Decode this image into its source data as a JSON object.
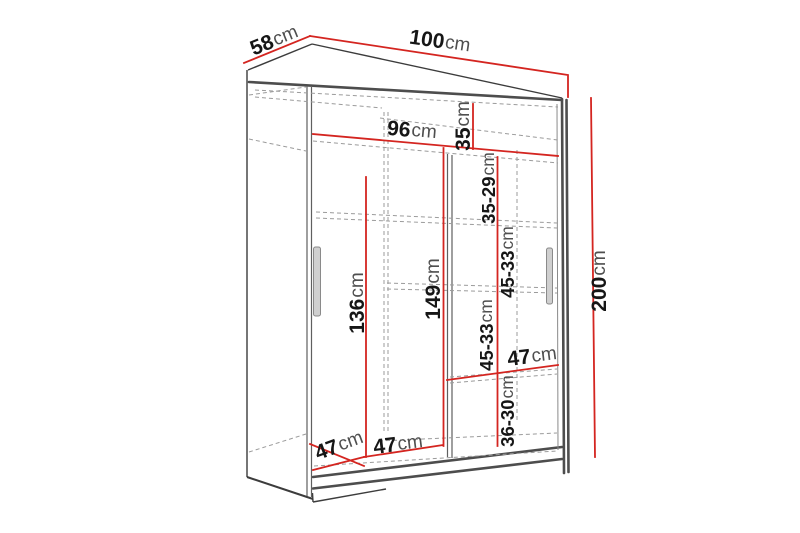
{
  "diagram": {
    "type": "furniture-dimension-diagram",
    "subject": "sliding-door wardrobe, 3D perspective view with measurements",
    "colors": {
      "dimension_line_red": "#d42520",
      "outline_dark": "#4d4d4d",
      "hidden_edge_dashed_gray": "#9b9b9b",
      "background": "#ffffff"
    }
  },
  "labels": {
    "depth": {
      "value": "58",
      "unit": "cm"
    },
    "width": {
      "value": "100",
      "unit": "cm"
    },
    "interior_width": {
      "value": "96",
      "unit": "cm"
    },
    "top_gap": {
      "value": "35",
      "unit": "cm"
    },
    "gap1": {
      "value": "35-29",
      "unit": "cm"
    },
    "gap2": {
      "value": "45-33",
      "unit": "cm"
    },
    "gap3": {
      "value": "45-33",
      "unit": "cm"
    },
    "gap4": {
      "value": "36-30",
      "unit": "cm"
    },
    "left_height": {
      "value": "136",
      "unit": "cm"
    },
    "mid_height": {
      "value": "149",
      "unit": "cm"
    },
    "total_height": {
      "value": "200",
      "unit": "cm"
    },
    "floor_left": {
      "value": "47",
      "unit": "cm"
    },
    "floor_mid": {
      "value": "47",
      "unit": "cm"
    },
    "shelf_width": {
      "value": "47",
      "unit": "cm"
    }
  }
}
